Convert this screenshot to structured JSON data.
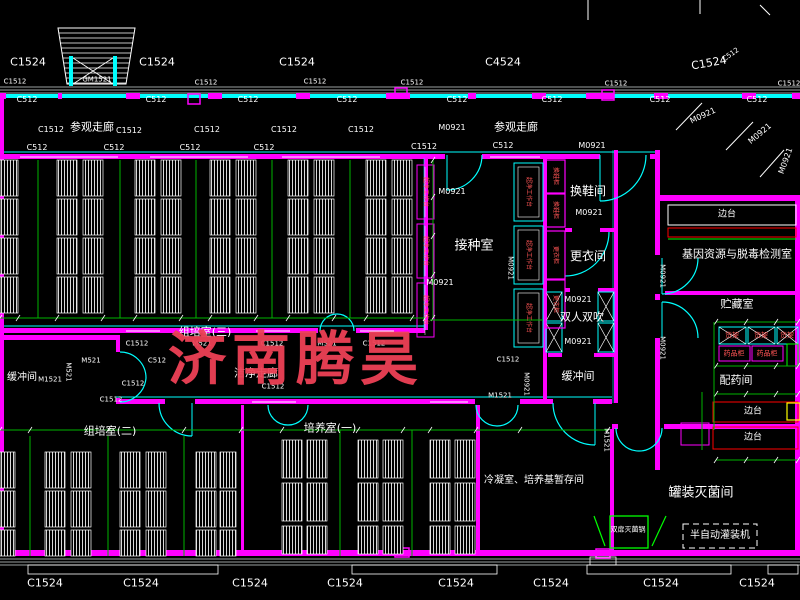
{
  "watermark": {
    "text": "济南腾昊",
    "color": "#ee4156"
  },
  "colors": {
    "wall_magenta": "#ff00ff",
    "wall_cyan": "#00ffff",
    "dim_green": "#00b400",
    "equip_green": "#00ff00",
    "bench_red": "#ff0000",
    "label_red": "#ff5555",
    "yellow": "#ffff00",
    "white": "#ffffff"
  },
  "codes": [
    {
      "t": "C1524",
      "x": 28,
      "y": 62,
      "s": 11
    },
    {
      "t": "C1524",
      "x": 157,
      "y": 62,
      "s": 11
    },
    {
      "t": "C1524",
      "x": 297,
      "y": 62,
      "s": 11
    },
    {
      "t": "C4524",
      "x": 503,
      "y": 62,
      "s": 11
    },
    {
      "t": "C1524",
      "x": 709,
      "y": 63,
      "s": 11,
      "r": -10
    },
    {
      "t": "C512",
      "x": 731,
      "y": 55,
      "s": 7,
      "r": -35
    },
    {
      "t": "GM1521",
      "x": 97,
      "y": 80,
      "s": 7
    },
    {
      "t": "C1512",
      "x": 15,
      "y": 82,
      "s": 7
    },
    {
      "t": "C1512",
      "x": 206,
      "y": 83,
      "s": 7
    },
    {
      "t": "C1512",
      "x": 315,
      "y": 82,
      "s": 7
    },
    {
      "t": "C1512",
      "x": 412,
      "y": 83,
      "s": 7
    },
    {
      "t": "C1512",
      "x": 616,
      "y": 84,
      "s": 7
    },
    {
      "t": "C1512",
      "x": 789,
      "y": 84,
      "s": 7
    },
    {
      "t": "C512",
      "x": 27,
      "y": 100,
      "s": 8
    },
    {
      "t": "C512",
      "x": 156,
      "y": 100,
      "s": 8
    },
    {
      "t": "C512",
      "x": 248,
      "y": 100,
      "s": 8
    },
    {
      "t": "C512",
      "x": 347,
      "y": 100,
      "s": 8
    },
    {
      "t": "C512",
      "x": 457,
      "y": 100,
      "s": 8
    },
    {
      "t": "C512",
      "x": 552,
      "y": 100,
      "s": 8
    },
    {
      "t": "C512",
      "x": 660,
      "y": 100,
      "s": 8
    },
    {
      "t": "C512",
      "x": 757,
      "y": 100,
      "s": 8
    },
    {
      "t": "C1512",
      "x": 51,
      "y": 130,
      "s": 8
    },
    {
      "t": "C1512",
      "x": 129,
      "y": 131,
      "s": 8
    },
    {
      "t": "C1512",
      "x": 207,
      "y": 130,
      "s": 8
    },
    {
      "t": "C1512",
      "x": 284,
      "y": 130,
      "s": 8
    },
    {
      "t": "C1512",
      "x": 361,
      "y": 130,
      "s": 8
    },
    {
      "t": "M0921",
      "x": 452,
      "y": 128,
      "s": 8
    },
    {
      "t": "M0921",
      "x": 703,
      "y": 116,
      "s": 8,
      "r": -25
    },
    {
      "t": "M0921",
      "x": 760,
      "y": 134,
      "s": 8,
      "r": -40
    },
    {
      "t": "M0921",
      "x": 786,
      "y": 161,
      "s": 8,
      "r": -70
    },
    {
      "t": "C512",
      "x": 37,
      "y": 148,
      "s": 8
    },
    {
      "t": "C512",
      "x": 114,
      "y": 148,
      "s": 8
    },
    {
      "t": "C512",
      "x": 190,
      "y": 148,
      "s": 8
    },
    {
      "t": "C512",
      "x": 264,
      "y": 148,
      "s": 8
    },
    {
      "t": "C1512",
      "x": 424,
      "y": 147,
      "s": 8
    },
    {
      "t": "C512",
      "x": 503,
      "y": 146,
      "s": 8
    },
    {
      "t": "M0921",
      "x": 592,
      "y": 146,
      "s": 8
    },
    {
      "t": "M0921",
      "x": 452,
      "y": 192,
      "s": 8
    },
    {
      "t": "M0921",
      "x": 440,
      "y": 283,
      "s": 8
    },
    {
      "t": "M0921",
      "x": 510,
      "y": 268,
      "s": 7,
      "r": 90
    },
    {
      "t": "M0921",
      "x": 589,
      "y": 213,
      "s": 8
    },
    {
      "t": "M0921",
      "x": 578,
      "y": 300,
      "s": 8
    },
    {
      "t": "M0921",
      "x": 578,
      "y": 342,
      "s": 8
    },
    {
      "t": "M0921",
      "x": 526,
      "y": 384,
      "s": 7,
      "r": 90
    },
    {
      "t": "C1512",
      "x": 508,
      "y": 360,
      "s": 7
    },
    {
      "t": "M0921",
      "x": 662,
      "y": 276,
      "s": 7,
      "r": 90
    },
    {
      "t": "M0921",
      "x": 662,
      "y": 348,
      "s": 7,
      "r": 90
    },
    {
      "t": "M1521",
      "x": 606,
      "y": 440,
      "s": 7,
      "r": 90
    },
    {
      "t": "M521",
      "x": 202,
      "y": 344,
      "s": 7
    },
    {
      "t": "C1512",
      "x": 272,
      "y": 344,
      "s": 7
    },
    {
      "t": "MS21",
      "x": 327,
      "y": 344,
      "s": 7
    },
    {
      "t": "C1512",
      "x": 374,
      "y": 344,
      "s": 7
    },
    {
      "t": "C1512",
      "x": 137,
      "y": 344,
      "s": 7
    },
    {
      "t": "C512",
      "x": 157,
      "y": 361,
      "s": 7
    },
    {
      "t": "M1521",
      "x": 50,
      "y": 380,
      "s": 7
    },
    {
      "t": "M521",
      "x": 68,
      "y": 372,
      "s": 7,
      "r": 90
    },
    {
      "t": "M521",
      "x": 91,
      "y": 361,
      "s": 7
    },
    {
      "t": "C1512",
      "x": 133,
      "y": 384,
      "s": 7
    },
    {
      "t": "C1512",
      "x": 111,
      "y": 400,
      "s": 7
    },
    {
      "t": "C1512",
      "x": 273,
      "y": 387,
      "s": 7
    },
    {
      "t": "M1521",
      "x": 500,
      "y": 396,
      "s": 7
    },
    {
      "t": "C1524",
      "x": 45,
      "y": 583,
      "s": 11
    },
    {
      "t": "C1524",
      "x": 141,
      "y": 583,
      "s": 11
    },
    {
      "t": "C1524",
      "x": 250,
      "y": 583,
      "s": 11
    },
    {
      "t": "C1524",
      "x": 345,
      "y": 583,
      "s": 11
    },
    {
      "t": "C1524",
      "x": 456,
      "y": 583,
      "s": 11
    },
    {
      "t": "C1524",
      "x": 551,
      "y": 583,
      "s": 11
    },
    {
      "t": "C1524",
      "x": 661,
      "y": 583,
      "s": 11
    },
    {
      "t": "C1524",
      "x": 757,
      "y": 583,
      "s": 11
    }
  ],
  "rooms": [
    {
      "t": "参观走廊",
      "x": 92,
      "y": 127,
      "s": 11
    },
    {
      "t": "参观走廊",
      "x": 516,
      "y": 127,
      "s": 11
    },
    {
      "t": "接种室",
      "x": 474,
      "y": 246,
      "s": 13
    },
    {
      "t": "换鞋间",
      "x": 588,
      "y": 191,
      "s": 12
    },
    {
      "t": "更衣间",
      "x": 588,
      "y": 256,
      "s": 12
    },
    {
      "t": "双人双吹",
      "x": 582,
      "y": 317,
      "s": 11
    },
    {
      "t": "缓冲间",
      "x": 578,
      "y": 376,
      "s": 11
    },
    {
      "t": "缓冲间",
      "x": 22,
      "y": 378,
      "s": 10
    },
    {
      "t": "基因资源与脱毒检测室",
      "x": 737,
      "y": 254,
      "s": 11
    },
    {
      "t": "贮藏室",
      "x": 737,
      "y": 304,
      "s": 11
    },
    {
      "t": "配药间",
      "x": 736,
      "y": 380,
      "s": 11
    },
    {
      "t": "组培室(三)",
      "x": 205,
      "y": 332,
      "s": 11
    },
    {
      "t": "组培室(二)",
      "x": 110,
      "y": 431,
      "s": 11
    },
    {
      "t": "培养室(一)",
      "x": 330,
      "y": 428,
      "s": 11
    },
    {
      "t": "洁净走廊",
      "x": 256,
      "y": 373,
      "s": 11
    },
    {
      "t": "冷凝室、培养基暂存间",
      "x": 534,
      "y": 481,
      "s": 10
    },
    {
      "t": "罐装灭菌间",
      "x": 701,
      "y": 493,
      "s": 13
    }
  ],
  "equipment": [
    {
      "t": "边台",
      "x": 727,
      "y": 215,
      "s": 9
    },
    {
      "t": "边台",
      "x": 753,
      "y": 412,
      "s": 9
    },
    {
      "t": "边台",
      "x": 753,
      "y": 438,
      "s": 9
    },
    {
      "t": "货架",
      "x": 732,
      "y": 336,
      "s": 7,
      "c": "#ff5555"
    },
    {
      "t": "货架",
      "x": 761,
      "y": 336,
      "s": 7,
      "c": "#ff5555"
    },
    {
      "t": "货架",
      "x": 787,
      "y": 336,
      "s": 7,
      "c": "#ff5555"
    },
    {
      "t": "药品柜",
      "x": 734,
      "y": 354,
      "s": 7,
      "c": "#ff5555"
    },
    {
      "t": "药品柜",
      "x": 767,
      "y": 354,
      "s": 7,
      "c": "#ff5555"
    },
    {
      "t": "超净工作台",
      "x": 425,
      "y": 192,
      "s": 6,
      "c": "#ff5555",
      "r": 90
    },
    {
      "t": "超净工作台",
      "x": 425,
      "y": 251,
      "s": 6,
      "c": "#ff5555",
      "r": 90
    },
    {
      "t": "超净工作台",
      "x": 425,
      "y": 310,
      "s": 6,
      "c": "#ff5555",
      "r": 90
    },
    {
      "t": "超净工作台",
      "x": 528,
      "y": 192,
      "s": 6,
      "c": "#ff5555",
      "r": 90
    },
    {
      "t": "超净工作台",
      "x": 528,
      "y": 255,
      "s": 6,
      "c": "#ff5555",
      "r": 90
    },
    {
      "t": "超净工作台",
      "x": 528,
      "y": 318,
      "s": 6,
      "c": "#ff5555",
      "r": 90
    },
    {
      "t": "换鞋柜",
      "x": 555,
      "y": 176,
      "s": 6,
      "c": "#ff5555",
      "r": 90
    },
    {
      "t": "换鞋柜",
      "x": 555,
      "y": 210,
      "s": 6,
      "c": "#ff5555",
      "r": 90
    },
    {
      "t": "更衣柜",
      "x": 555,
      "y": 255,
      "s": 6,
      "c": "#ff5555",
      "r": 90
    },
    {
      "t": "更衣柜",
      "x": 555,
      "y": 304,
      "s": 6,
      "c": "#ff5555",
      "r": 90
    },
    {
      "t": "双扉灭菌锅",
      "x": 628,
      "y": 530,
      "s": 7
    },
    {
      "t": "半自动灌装机",
      "x": 720,
      "y": 536,
      "s": 10
    }
  ]
}
